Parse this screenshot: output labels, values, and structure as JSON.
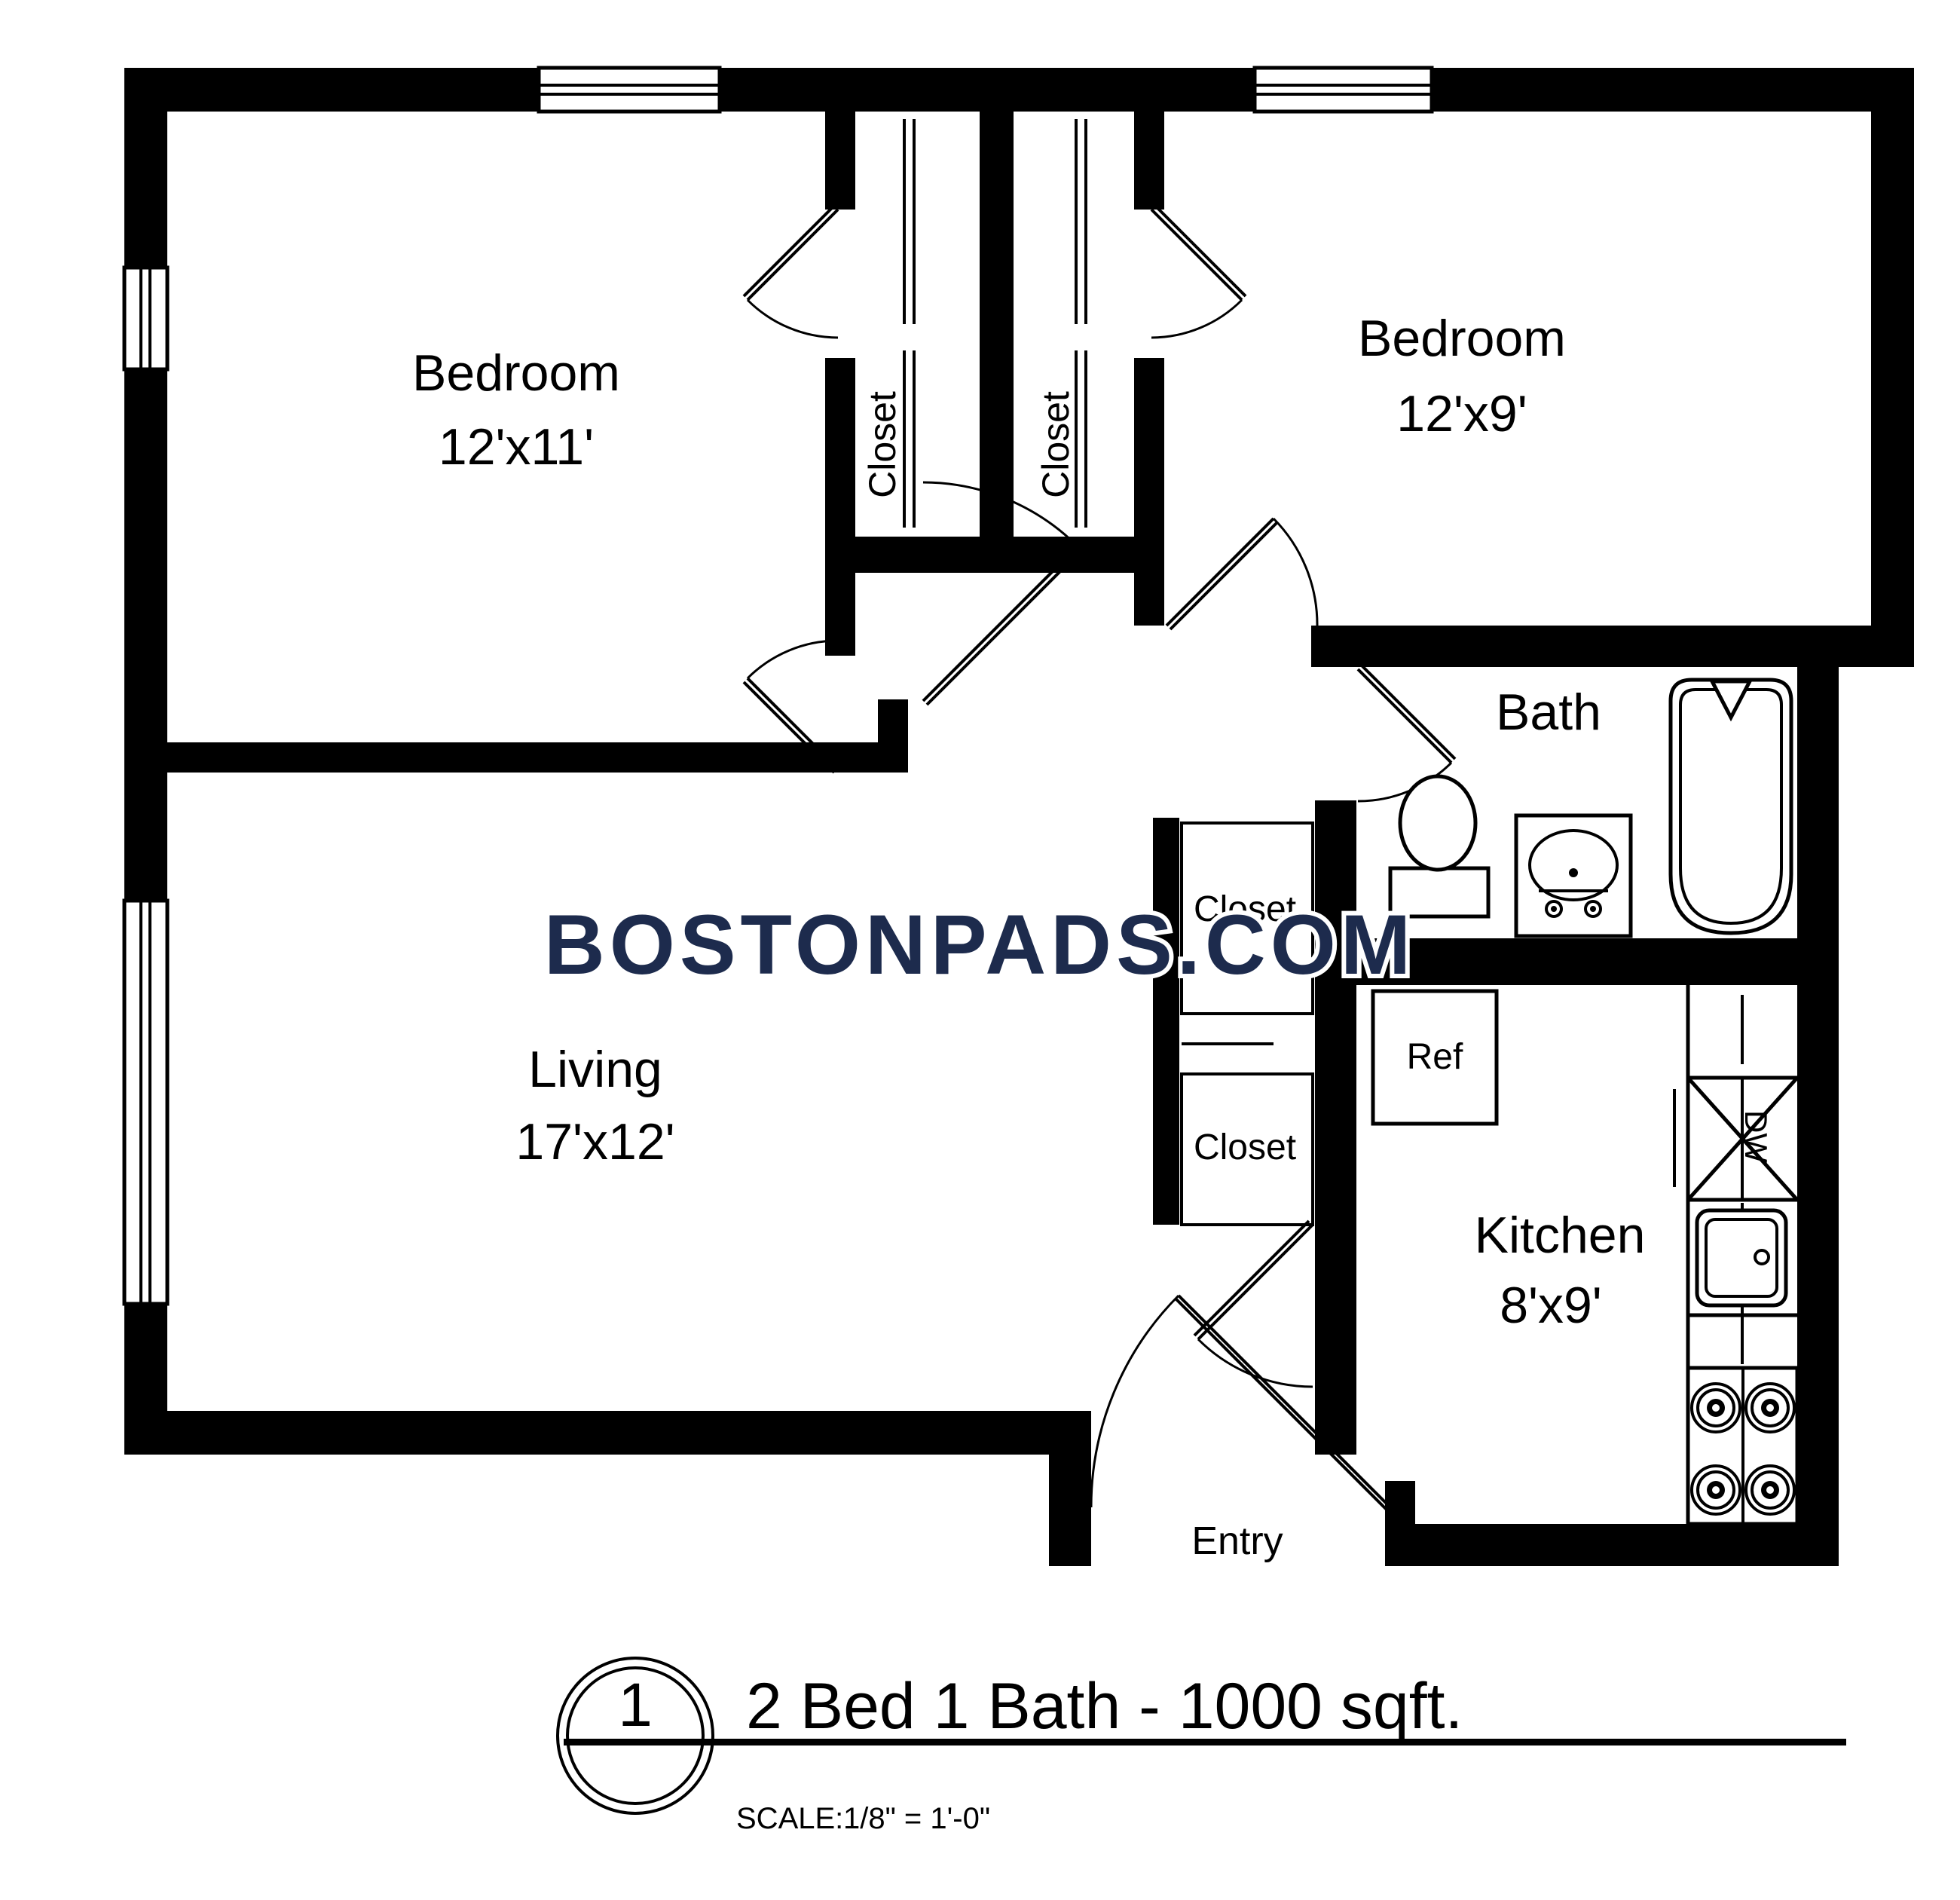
{
  "watermark": {
    "text": "BOSTONPADS.COM"
  },
  "rooms": {
    "bedroom_left": {
      "name": "Bedroom",
      "dims": "12'x11'"
    },
    "bedroom_right": {
      "name": "Bedroom",
      "dims": "12'x9'"
    },
    "living": {
      "name": "Living",
      "dims": "17'x12'"
    },
    "kitchen": {
      "name": "Kitchen",
      "dims": "8'x9'"
    },
    "bath": {
      "name": "Bath"
    }
  },
  "closets": {
    "bedroom_left_closet": "Closet",
    "bedroom_right_closet": "Closet",
    "hall_closet_upper": "Closet",
    "hall_closet_lower": "Closet"
  },
  "fixtures": {
    "refrigerator": "Ref",
    "dishwasher": "DW"
  },
  "entry": {
    "label": "Entry"
  },
  "title_block": {
    "plan_number": "1",
    "title": "2 Bed 1 Bath - 1000 sqft.",
    "scale_label": "SCALE:",
    "scale_value": "1/8\" = 1'-0\""
  },
  "colors": {
    "walls": "#000000",
    "background": "#ffffff",
    "watermark": "#1d2b4d"
  }
}
